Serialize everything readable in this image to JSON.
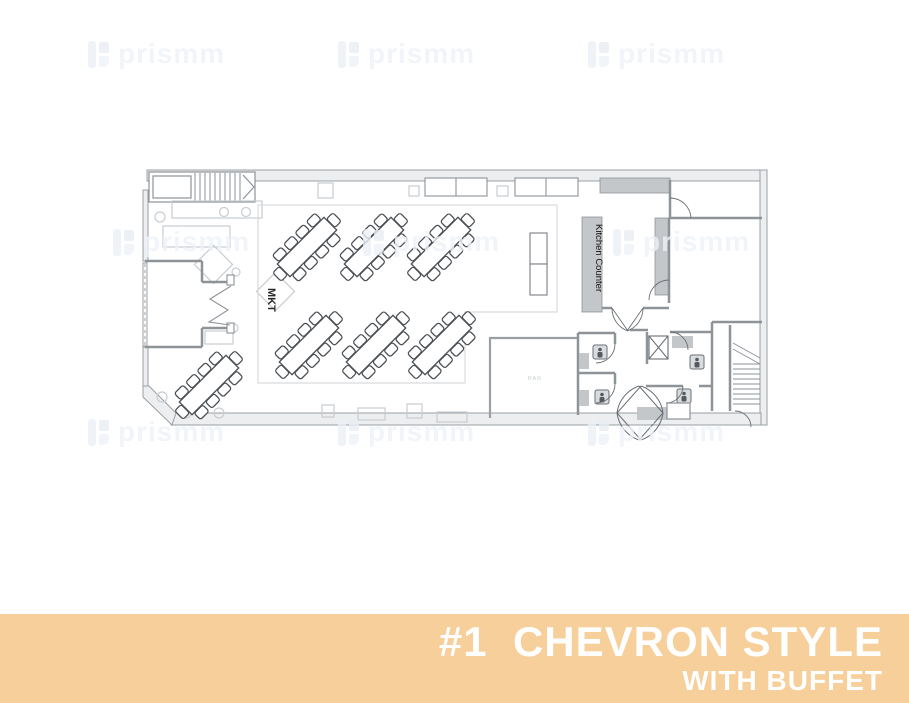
{
  "banner": {
    "line1": "#1  CHEVRON STYLE",
    "line2": "WITH BUFFET",
    "bg_color": "#f6cf9a",
    "text_color": "#ffffff"
  },
  "watermark": {
    "text": "prismm"
  },
  "floorplan": {
    "labels": {
      "market": "MKT",
      "kitchen_counter": "Kitchen Counter",
      "bar": "BAR"
    },
    "style_name": "Chevron",
    "tables": {
      "chevron_table_count": 6,
      "extra_table_count": 1,
      "seats_per_table": 10,
      "rotation_deg": -45,
      "positions": [
        {
          "x": 164,
          "y": 79,
          "rot": -45
        },
        {
          "x": 231,
          "y": 79,
          "rot": -45
        },
        {
          "x": 298,
          "y": 79,
          "rot": -45
        },
        {
          "x": 166,
          "y": 177,
          "rot": -45
        },
        {
          "x": 233,
          "y": 177,
          "rot": -45
        },
        {
          "x": 299,
          "y": 177,
          "rot": -45
        },
        {
          "x": 66,
          "y": 217,
          "rot": -45
        }
      ]
    },
    "colors": {
      "wall_fill": "#eceeef",
      "wall_stroke": "#9aa0a5",
      "counter_fill": "#c3c7ca",
      "furniture_stroke": "#4a4f54",
      "light_furniture_stroke": "#c9cdd1"
    }
  }
}
